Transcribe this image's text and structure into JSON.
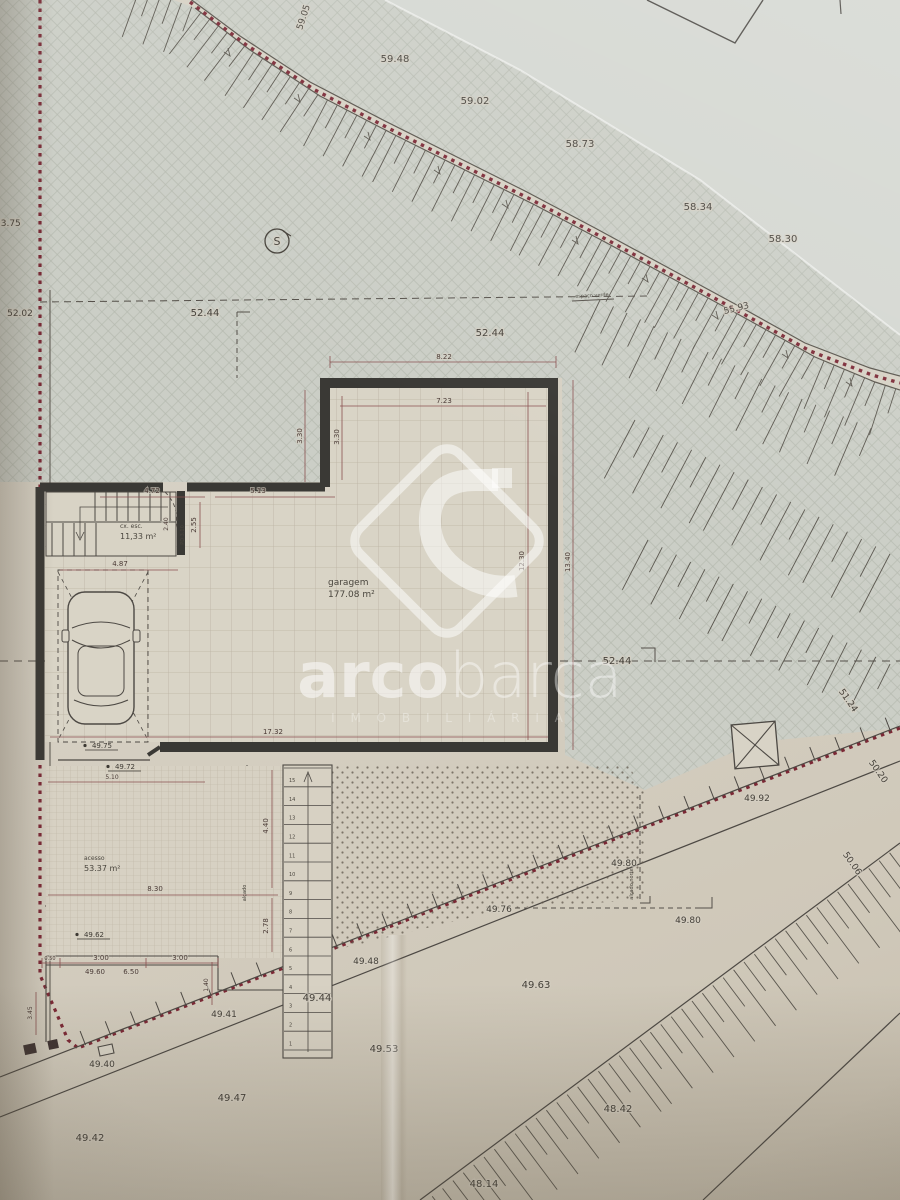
{
  "watermark": {
    "brand_bold": "arco",
    "brand_light": "barca",
    "tagline": "I M O B I L I Á R I A"
  },
  "plan": {
    "rooms": [
      {
        "name": "garagem",
        "area": "177.08 m²"
      },
      {
        "name": "cx. esc.",
        "area": "11,33 m²"
      },
      {
        "name": "acesso",
        "area": "53.37 m²"
      }
    ],
    "north_symbol": "S",
    "stairs": {
      "count": 15
    },
    "texts": [
      {
        "t": "59.48",
        "x": 395,
        "y": 62,
        "s": 10,
        "c": "el"
      },
      {
        "t": "59.02",
        "x": 475,
        "y": 104,
        "s": 10,
        "c": "el"
      },
      {
        "t": "58.73",
        "x": 580,
        "y": 147,
        "s": 10,
        "c": "el"
      },
      {
        "t": "58.34",
        "x": 698,
        "y": 210,
        "s": 10,
        "c": "el"
      },
      {
        "t": "58.30",
        "x": 783,
        "y": 242,
        "s": 10,
        "c": "el"
      },
      {
        "t": "55.93",
        "x": 737,
        "y": 311,
        "s": 9,
        "r": -14,
        "c": "el"
      },
      {
        "t": "59.05",
        "x": 306,
        "y": 18,
        "s": 9,
        "r": -72,
        "c": "el"
      },
      {
        "t": "53.75",
        "x": -5,
        "y": 226,
        "s": 9,
        "c": "el",
        "a": "start"
      },
      {
        "t": "52.02",
        "x": 20,
        "y": 316,
        "s": 9,
        "c": "el"
      },
      {
        "t": "52.44",
        "x": 205,
        "y": 316,
        "s": 10,
        "c": "el"
      },
      {
        "t": "52.44",
        "x": 490,
        "y": 336,
        "s": 10,
        "c": "el"
      },
      {
        "t": "52.44",
        "x": 617,
        "y": 664,
        "s": 10,
        "c": "el"
      },
      {
        "t": "51.24",
        "x": 846,
        "y": 702,
        "s": 9,
        "r": 55,
        "c": "el"
      },
      {
        "t": "50.20",
        "x": 876,
        "y": 773,
        "s": 9,
        "r": 55,
        "c": "el"
      },
      {
        "t": "50.06",
        "x": 850,
        "y": 865,
        "s": 9,
        "r": 55,
        "c": "el"
      },
      {
        "t": "49.92",
        "x": 757,
        "y": 801,
        "s": 9,
        "c": "el"
      },
      {
        "t": "49.80",
        "x": 624,
        "y": 866,
        "s": 9,
        "c": "el"
      },
      {
        "t": "49.80",
        "x": 688,
        "y": 923,
        "s": 9,
        "c": "el"
      },
      {
        "t": "49.76",
        "x": 499,
        "y": 912,
        "s": 9,
        "c": "el"
      },
      {
        "t": "49.63",
        "x": 536,
        "y": 988,
        "s": 10,
        "c": "el"
      },
      {
        "t": "49.48",
        "x": 366,
        "y": 964,
        "s": 9,
        "c": "el"
      },
      {
        "t": "49.44",
        "x": 317,
        "y": 1001,
        "s": 10,
        "c": "el"
      },
      {
        "t": "49.53",
        "x": 384,
        "y": 1052,
        "s": 10,
        "c": "el"
      },
      {
        "t": "49.41",
        "x": 224,
        "y": 1017,
        "s": 9,
        "c": "el"
      },
      {
        "t": "49.40",
        "x": 102,
        "y": 1067,
        "s": 9,
        "c": "el"
      },
      {
        "t": "49.47",
        "x": 232,
        "y": 1101,
        "s": 10,
        "c": "el"
      },
      {
        "t": "49.42",
        "x": 90,
        "y": 1141,
        "s": 10,
        "c": "el"
      },
      {
        "t": "48.42",
        "x": 618,
        "y": 1112,
        "s": 10,
        "c": "el"
      },
      {
        "t": "48.14",
        "x": 484,
        "y": 1187,
        "s": 10,
        "c": "el"
      },
      {
        "t": "49.75",
        "x": 102,
        "y": 748,
        "s": 7,
        "c": "bm"
      },
      {
        "t": "49.72",
        "x": 125,
        "y": 769,
        "s": 7,
        "c": "bm"
      },
      {
        "t": "49.62",
        "x": 94,
        "y": 937,
        "s": 7,
        "c": "bm"
      },
      {
        "t": "8.22",
        "x": 444,
        "y": 359,
        "s": 7,
        "c": "dim"
      },
      {
        "t": "7.23",
        "x": 444,
        "y": 403,
        "s": 7,
        "c": "dim"
      },
      {
        "t": "3.30",
        "x": 302,
        "y": 436,
        "s": 7,
        "r": -90,
        "c": "dim"
      },
      {
        "t": "3.30",
        "x": 339,
        "y": 437,
        "s": 7,
        "r": -90,
        "c": "dim"
      },
      {
        "t": "4.72",
        "x": 152,
        "y": 493,
        "s": 7,
        "c": "dim"
      },
      {
        "t": "5.13",
        "x": 258,
        "y": 493,
        "s": 7,
        "c": "dim"
      },
      {
        "t": "2.55",
        "x": 196,
        "y": 525,
        "s": 7,
        "r": -90,
        "c": "dim"
      },
      {
        "t": "2.40",
        "x": 168,
        "y": 524,
        "s": 6,
        "r": -90,
        "c": "dim"
      },
      {
        "t": "4.87",
        "x": 120,
        "y": 566,
        "s": 7,
        "c": "dim"
      },
      {
        "t": "17.32",
        "x": 273,
        "y": 734,
        "s": 7,
        "c": "dim"
      },
      {
        "t": "12.30",
        "x": 524,
        "y": 561,
        "s": 7,
        "r": -90,
        "c": "dim"
      },
      {
        "t": "13.40",
        "x": 570,
        "y": 562,
        "s": 7,
        "r": -90,
        "c": "dim"
      },
      {
        "t": "5.10",
        "x": 112,
        "y": 779,
        "s": 6,
        "c": "dim"
      },
      {
        "t": "8.30",
        "x": 155,
        "y": 891,
        "s": 7,
        "c": "dim"
      },
      {
        "t": "4.40",
        "x": 268,
        "y": 826,
        "s": 7,
        "r": -90,
        "c": "dim"
      },
      {
        "t": "2.78",
        "x": 268,
        "y": 926,
        "s": 7,
        "r": -90,
        "c": "dim"
      },
      {
        "t": "1.40",
        "x": 208,
        "y": 985,
        "s": 6,
        "r": -90,
        "c": "dim"
      },
      {
        "t": "3.45",
        "x": 32,
        "y": 1013,
        "s": 6,
        "r": -90,
        "c": "dim"
      },
      {
        "t": "0.50",
        "x": 50,
        "y": 960,
        "s": 5,
        "c": "dim"
      },
      {
        "t": "3.00",
        "x": 101,
        "y": 960,
        "s": 7,
        "c": "dim"
      },
      {
        "t": "3.00",
        "x": 180,
        "y": 960,
        "s": 7,
        "c": "dim"
      },
      {
        "t": "49.60",
        "x": 95,
        "y": 974,
        "s": 7,
        "c": "dim"
      },
      {
        "t": "6.50",
        "x": 131,
        "y": 974,
        "s": 7,
        "c": "dim"
      },
      {
        "t": "garagem",
        "x": 328,
        "y": 585,
        "s": 9,
        "c": "room",
        "a": "start"
      },
      {
        "t": "177.08 m²",
        "x": 328,
        "y": 597,
        "s": 9,
        "c": "room",
        "a": "start"
      },
      {
        "t": "cx. esc.",
        "x": 120,
        "y": 528,
        "s": 6,
        "c": "room",
        "a": "start"
      },
      {
        "t": "11,33 m²",
        "x": 120,
        "y": 539,
        "s": 8,
        "c": "room",
        "a": "start"
      },
      {
        "t": "acesso",
        "x": 84,
        "y": 860,
        "s": 6,
        "c": "room",
        "a": "start"
      },
      {
        "t": "53.37 m²",
        "x": 84,
        "y": 871,
        "s": 8,
        "c": "room",
        "a": "start"
      },
      {
        "t": "espaço verde",
        "x": 592,
        "y": 297,
        "s": 5,
        "r": -3,
        "c": "ann"
      },
      {
        "t": "alçado norte",
        "x": 633,
        "y": 884,
        "s": 5,
        "r": -90,
        "c": "ann"
      },
      {
        "t": "alçado",
        "x": 246,
        "y": 893,
        "s": 5,
        "r": -90,
        "c": "ann"
      },
      {
        "t": "PD 3.10",
        "x": 184,
        "y": 535,
        "s": 5,
        "r": -90,
        "c": "ann"
      },
      {
        "t": "S",
        "x": 277,
        "y": 245,
        "s": 11,
        "c": "el"
      }
    ]
  }
}
